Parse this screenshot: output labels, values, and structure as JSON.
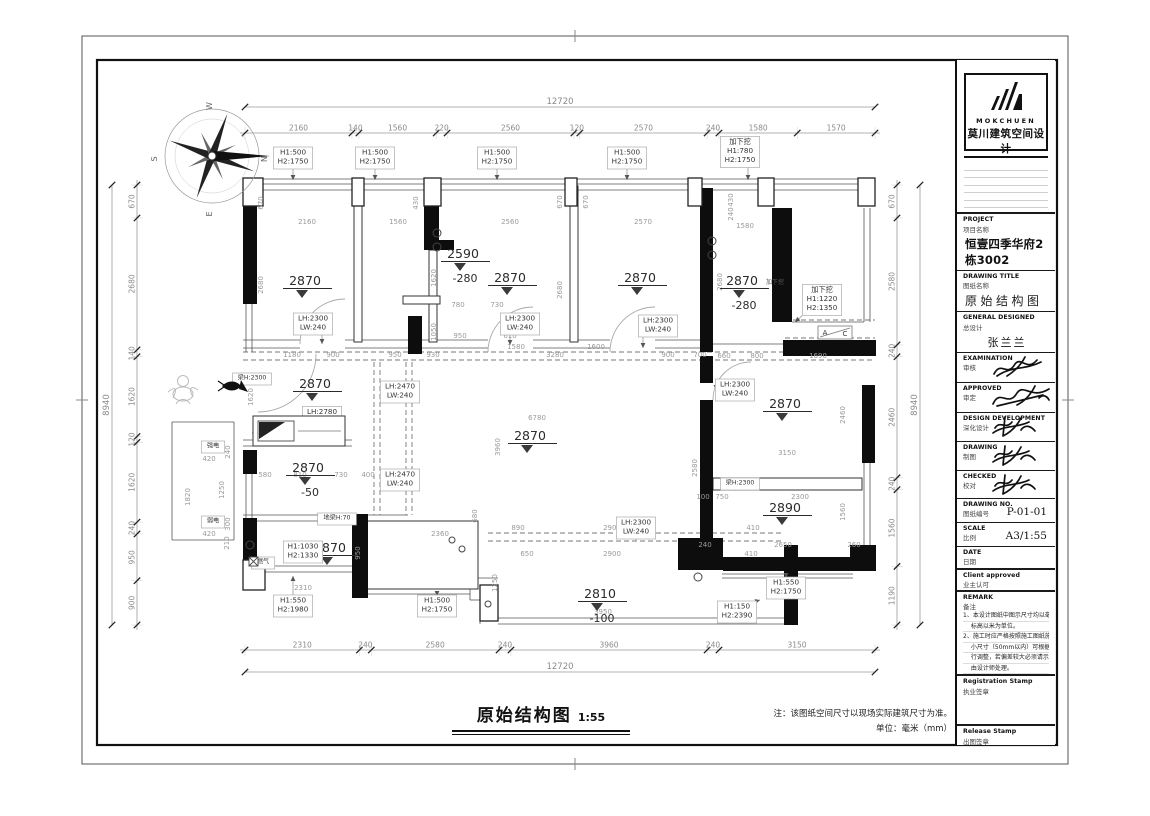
{
  "footer": {
    "title": "原始结构图",
    "scale": "1:55",
    "note1": "注：该图纸空间尺寸以现场实际建筑尺寸为准。",
    "note2": "单位：毫米（mm）"
  },
  "titleblock": {
    "logo": {
      "brand": "MOKCHUEN",
      "brand_cn": "莫川建筑空间设计"
    },
    "rows": [
      {
        "en": "PROJECT",
        "cn": "项目名称",
        "value": "恒壹四季华府2栋3002",
        "style": "lg",
        "h": 40,
        "thick": true
      },
      {
        "en": "DRAWING TITLE",
        "cn": "图纸名称",
        "value": "原始结构图",
        "style": "spaced",
        "h": 38
      },
      {
        "en": "GENERAL DESIGNED",
        "cn": "总设计",
        "value": "张兰兰",
        "style": "center",
        "h": 34
      },
      {
        "en": "EXAMINATION",
        "cn": "审核",
        "sig": 1,
        "h": 30
      },
      {
        "en": "APPROVED",
        "cn": "审定",
        "sig": 2,
        "h": 30
      },
      {
        "en": "DESIGN DEVELOPMENT",
        "cn": "深化设计",
        "sig": 3,
        "h": 29
      },
      {
        "en": "DRAWING",
        "cn": "制图",
        "sig": 3,
        "h": 29
      },
      {
        "en": "CHECKED",
        "cn": "校对",
        "sig": 3,
        "h": 28
      },
      {
        "en": "DRAWING NO.",
        "cn": "图纸编号",
        "value": "P-01-01",
        "style": "inline",
        "h": 24
      },
      {
        "en": "SCALE",
        "cn": "比例",
        "value": "A3/1:55",
        "style": "inline",
        "h": 24
      },
      {
        "en": "DATE",
        "cn": "日期",
        "h": 22
      },
      {
        "en": "Client approved",
        "cn": "业主认可",
        "h": 22,
        "thick": true
      }
    ],
    "remark": {
      "en": "REMARK",
      "cn": "备注",
      "thick": true,
      "lines": [
        "1、本设计图纸中图示尺寸均以毫米为单位，",
        "　 标高以米为单位。",
        "2、施工时应严格按照施工图纸施工，局部",
        "　 小尺寸（50mm以内）可根据现场实况进",
        "　 行调整，若偏差较大必须请示设计师，",
        "　 由设计师处理。"
      ]
    },
    "stamps": [
      {
        "en": "Registration Stamp",
        "cn": "执业签章",
        "h": 50,
        "thick": true
      },
      {
        "en": "Release Stamp",
        "cn": "出图签章",
        "h": 58,
        "thick": true
      }
    ]
  },
  "plan": {
    "chains": [
      {
        "o": "h",
        "x0": 245,
        "x1": 875,
        "y": 133,
        "vals": [
          2160,
          140,
          1560,
          220,
          2560,
          120,
          2570,
          240,
          1580,
          1570
        ]
      },
      {
        "o": "h",
        "x0": 245,
        "x1": 875,
        "y": 650,
        "vals": [
          2310,
          240,
          2580,
          240,
          3960,
          240,
          3150
        ]
      },
      {
        "o": "v",
        "x": 137,
        "y0": 185,
        "y1": 625,
        "vals": [
          670,
          2680,
          140,
          1620,
          120,
          1620,
          240,
          950,
          900
        ]
      },
      {
        "o": "v",
        "x": 897,
        "y0": 185,
        "y1": 625,
        "vals": [
          670,
          2580,
          240,
          2460,
          240,
          1560,
          1190
        ]
      }
    ],
    "overall": [
      {
        "o": "h",
        "x0": 245,
        "x1": 875,
        "y": 107,
        "t": "12720"
      },
      {
        "o": "h",
        "x0": 245,
        "x1": 875,
        "y": 672,
        "t": "12720"
      },
      {
        "o": "v",
        "x": 112,
        "y0": 185,
        "y1": 625,
        "t": "8940"
      },
      {
        "o": "v",
        "x": 920,
        "y0": 185,
        "y1": 625,
        "t": "8940"
      }
    ],
    "walls": [
      [
        243,
        204,
        14,
        100
      ],
      [
        243,
        450,
        14,
        24
      ],
      [
        243,
        518,
        14,
        46
      ],
      [
        352,
        514,
        16,
        84
      ],
      [
        408,
        316,
        14,
        38
      ],
      [
        424,
        204,
        15,
        38
      ],
      [
        424,
        240,
        30,
        10
      ],
      [
        700,
        188,
        13,
        164
      ],
      [
        772,
        208,
        20,
        114
      ],
      [
        783,
        340,
        93,
        16
      ],
      [
        700,
        356,
        13,
        27
      ],
      [
        700,
        400,
        13,
        140
      ],
      [
        678,
        538,
        45,
        32
      ],
      [
        784,
        545,
        14,
        80
      ],
      [
        723,
        557,
        127,
        14
      ],
      [
        850,
        545,
        26,
        26
      ],
      [
        862,
        385,
        13,
        78
      ]
    ],
    "columns": [
      [
        243,
        178,
        20,
        28
      ],
      [
        352,
        178,
        12,
        28
      ],
      [
        424,
        178,
        17,
        28
      ],
      [
        565,
        178,
        12,
        28
      ],
      [
        688,
        178,
        14,
        28
      ],
      [
        758,
        178,
        16,
        28
      ],
      [
        858,
        178,
        17,
        28
      ],
      [
        243,
        560,
        22,
        30
      ],
      [
        480,
        585,
        18,
        36
      ]
    ],
    "thinwalls": [
      [
        354,
        186,
        8,
        156
      ],
      [
        429,
        250,
        8,
        92
      ],
      [
        570,
        186,
        8,
        156
      ],
      [
        713,
        478,
        149,
        12
      ],
      [
        403,
        296,
        37,
        8
      ],
      [
        366,
        521,
        112,
        68
      ]
    ],
    "lines": [
      [
        243,
        179,
        875,
        179
      ],
      [
        243,
        184,
        875,
        184
      ],
      [
        243,
        190,
        875,
        190
      ],
      [
        246,
        304,
        246,
        352
      ],
      [
        252,
        304,
        252,
        352
      ],
      [
        246,
        466,
        246,
        518
      ],
      [
        252,
        466,
        252,
        518
      ],
      [
        257,
        566,
        352,
        566
      ],
      [
        257,
        572,
        352,
        572
      ],
      [
        498,
        618,
        790,
        618
      ],
      [
        498,
        624,
        790,
        624
      ],
      [
        470,
        578,
        498,
        578
      ],
      [
        470,
        578,
        470,
        600
      ],
      [
        470,
        600,
        480,
        600
      ],
      [
        480,
        600,
        480,
        624
      ],
      [
        864,
        208,
        864,
        322
      ],
      [
        870,
        208,
        870,
        322
      ],
      [
        864,
        460,
        864,
        545
      ],
      [
        870,
        460,
        870,
        545
      ],
      [
        243,
        340,
        300,
        340
      ],
      [
        243,
        348,
        300,
        348
      ],
      [
        345,
        340,
        488,
        340
      ],
      [
        345,
        348,
        488,
        348
      ],
      [
        533,
        340,
        610,
        340
      ],
      [
        533,
        348,
        610,
        348
      ],
      [
        655,
        340,
        700,
        340
      ],
      [
        655,
        348,
        700,
        348
      ],
      [
        713,
        344,
        783,
        344
      ],
      [
        243,
        440,
        352,
        440
      ],
      [
        243,
        446,
        352,
        446
      ],
      [
        243,
        515,
        408,
        515
      ],
      [
        243,
        521,
        408,
        521
      ],
      [
        365,
        588,
        470,
        588
      ],
      [
        365,
        594,
        470,
        594
      ],
      [
        722,
        574,
        853,
        574
      ],
      [
        722,
        578,
        853,
        578
      ],
      [
        792,
        322,
        864,
        322
      ],
      [
        172,
        422,
        234,
        422
      ],
      [
        172,
        422,
        172,
        540
      ],
      [
        172,
        540,
        234,
        540
      ],
      [
        234,
        422,
        234,
        540
      ]
    ],
    "dashed": [
      [
        243,
        352,
        875,
        352
      ],
      [
        243,
        360,
        875,
        360
      ],
      [
        374,
        362,
        374,
        515
      ],
      [
        380,
        362,
        380,
        515
      ],
      [
        406,
        362,
        406,
        515
      ],
      [
        412,
        362,
        412,
        515
      ],
      [
        488,
        533,
        784,
        533
      ],
      [
        488,
        541,
        784,
        541
      ],
      [
        785,
        320,
        875,
        320
      ],
      [
        785,
        338,
        875,
        338
      ],
      [
        252,
        433,
        348,
        433
      ]
    ],
    "circles": [
      [
        437,
        233,
        4
      ],
      [
        437,
        247,
        4
      ],
      [
        712,
        241,
        4
      ],
      [
        712,
        255,
        4
      ],
      [
        250,
        545,
        4
      ],
      [
        452,
        540,
        3
      ],
      [
        462,
        549,
        3
      ],
      [
        698,
        577,
        4
      ],
      [
        488,
        604,
        3
      ]
    ],
    "arcs": [
      "M316,354 A58,58 0 0 1 258,412",
      "M300,344 A45,45 0 0 1 345,299",
      "M488,352 A45,45 0 0 1 533,307",
      "M610,352 A45,45 0 0 1 655,307",
      "M713,400 A38,38 0 0 1 751,362"
    ],
    "levels": [
      {
        "v": "2870",
        "x": 305,
        "y": 285
      },
      {
        "v": "2590",
        "x": 463,
        "y": 258,
        "sub": "-280"
      },
      {
        "v": "2870",
        "x": 510,
        "y": 282
      },
      {
        "v": "2870",
        "x": 640,
        "y": 282
      },
      {
        "v": "2870",
        "x": 742,
        "y": 285,
        "sub": "-280",
        "tag": "加下挖"
      },
      {
        "v": "2870",
        "x": 315,
        "y": 388
      },
      {
        "v": "2870",
        "x": 530,
        "y": 440
      },
      {
        "v": "2870",
        "x": 308,
        "y": 472,
        "sub": "-50"
      },
      {
        "v": "2870",
        "x": 330,
        "y": 552
      },
      {
        "v": "2870",
        "x": 785,
        "y": 408
      },
      {
        "v": "2890",
        "x": 785,
        "y": 512
      },
      {
        "v": "2810",
        "x": 600,
        "y": 598,
        "sub": "-100"
      }
    ],
    "labels": [
      {
        "t": [
          "H1:500",
          "H2:1750"
        ],
        "x": 293,
        "y": 158,
        "lead": [
          293,
          180
        ]
      },
      {
        "t": [
          "H1:500",
          "H2:1750"
        ],
        "x": 375,
        "y": 158,
        "lead": [
          375,
          180
        ]
      },
      {
        "t": [
          "H1:500",
          "H2:1750"
        ],
        "x": 497,
        "y": 158,
        "lead": [
          497,
          180
        ]
      },
      {
        "t": [
          "H1:500",
          "H2:1750"
        ],
        "x": 627,
        "y": 158,
        "lead": [
          627,
          180
        ]
      },
      {
        "t": [
          "加下挖",
          "H1:780",
          "H2:1750"
        ],
        "x": 740,
        "y": 152,
        "lead": [
          748,
          180
        ]
      },
      {
        "t": [
          "加下挖",
          "H1:1220",
          "H2:1350"
        ],
        "x": 822,
        "y": 300,
        "lead": [
          795,
          322
        ]
      },
      {
        "t": [
          "LH:2300",
          "LW:240"
        ],
        "x": 313,
        "y": 324,
        "lead": [
          322,
          344
        ]
      },
      {
        "t": [
          "LH:2300",
          "LW:240"
        ],
        "x": 520,
        "y": 324,
        "lead": [
          510,
          345
        ]
      },
      {
        "t": [
          "LH:2300",
          "LW:240"
        ],
        "x": 658,
        "y": 326,
        "lead": [
          643,
          348
        ]
      },
      {
        "t": [
          "LH:2470",
          "LW:240"
        ],
        "x": 400,
        "y": 392,
        "lead": [
          414,
          392
        ]
      },
      {
        "t": [
          "LH:2470",
          "LW:240"
        ],
        "x": 400,
        "y": 480,
        "lead": [
          414,
          480
        ]
      },
      {
        "t": [
          "LH:2780"
        ],
        "x": 322,
        "y": 413
      },
      {
        "t": [
          "梁H:2300"
        ],
        "x": 252,
        "y": 379,
        "small": true
      },
      {
        "t": [
          "LH:2300",
          "LW:240"
        ],
        "x": 735,
        "y": 390,
        "lead": [
          716,
          390
        ]
      },
      {
        "t": [
          "梁H:2300"
        ],
        "x": 740,
        "y": 484,
        "small": true
      },
      {
        "t": [
          "地梁H:70"
        ],
        "x": 337,
        "y": 519,
        "small": true
      },
      {
        "t": [
          "H1:1030",
          "H2:1330"
        ],
        "x": 303,
        "y": 552
      },
      {
        "t": [
          "H1:550",
          "H2:1980"
        ],
        "x": 293,
        "y": 606,
        "lead": [
          293,
          576
        ]
      },
      {
        "t": [
          "H1:500",
          "H2:1750"
        ],
        "x": 437,
        "y": 606,
        "lead": [
          437,
          596
        ]
      },
      {
        "t": [
          "H1:550",
          "H2:1750"
        ],
        "x": 786,
        "y": 588,
        "lead": [
          786,
          578
        ]
      },
      {
        "t": [
          "H1:150",
          "H2:2390"
        ],
        "x": 737,
        "y": 612,
        "lead": [
          760,
          600
        ]
      },
      {
        "t": [
          "LH:2300",
          "LW:240"
        ],
        "x": 636,
        "y": 528,
        "lead": [
          636,
          540
        ]
      },
      {
        "t": [
          "强电"
        ],
        "x": 213,
        "y": 447,
        "small": true
      },
      {
        "t": [
          "弱电"
        ],
        "x": 213,
        "y": 522,
        "small": true
      },
      {
        "t": [
          "燃气"
        ],
        "x": 263,
        "y": 563,
        "small": true
      }
    ],
    "section_marker": {
      "a": "A",
      "c": "C",
      "x": 818,
      "y": 326,
      "w": 34,
      "h": 13
    },
    "dims": [
      [
        "2160",
        307,
        224
      ],
      [
        "1560",
        398,
        224
      ],
      [
        "2560",
        510,
        224
      ],
      [
        "2570",
        643,
        224
      ],
      [
        "1580",
        745,
        228
      ],
      [
        "670",
        263,
        203,
        1
      ],
      [
        "2680",
        263,
        285,
        1
      ],
      [
        "430",
        418,
        203,
        1
      ],
      [
        "1620",
        436,
        278,
        1
      ],
      [
        "1050",
        436,
        332,
        1
      ],
      [
        "780",
        458,
        307
      ],
      [
        "730",
        497,
        307
      ],
      [
        "950",
        460,
        338
      ],
      [
        "610",
        510,
        338
      ],
      [
        "810",
        518,
        320,
        1
      ],
      [
        "430",
        733,
        200,
        1
      ],
      [
        "240",
        733,
        214,
        1
      ],
      [
        "2680",
        722,
        282,
        1
      ],
      [
        "660",
        724,
        358
      ],
      [
        "800",
        757,
        358
      ],
      [
        "1690",
        818,
        358
      ],
      [
        "1180",
        292,
        357
      ],
      [
        "900",
        333,
        357
      ],
      [
        "950",
        395,
        357
      ],
      [
        "930",
        433,
        357
      ],
      [
        "3280",
        555,
        357
      ],
      [
        "900",
        668,
        357
      ],
      [
        "700",
        700,
        357
      ],
      [
        "1580",
        516,
        349
      ],
      [
        "1600",
        596,
        349
      ],
      [
        "670",
        562,
        202,
        1
      ],
      [
        "670",
        588,
        202,
        1
      ],
      [
        "2680",
        562,
        290,
        1
      ],
      [
        "2550",
        312,
        424
      ],
      [
        "1620",
        253,
        397,
        1
      ],
      [
        "580",
        265,
        477
      ],
      [
        "810",
        300,
        477
      ],
      [
        "730",
        341,
        477
      ],
      [
        "400",
        368,
        477
      ],
      [
        "2310",
        303,
        590
      ],
      [
        "950",
        360,
        553,
        1
      ],
      [
        "6780",
        537,
        420
      ],
      [
        "3960",
        500,
        447,
        1
      ],
      [
        "2360",
        440,
        536
      ],
      [
        "680",
        477,
        516,
        1
      ],
      [
        "2580",
        697,
        468,
        1
      ],
      [
        "890",
        518,
        530
      ],
      [
        "2900",
        612,
        530
      ],
      [
        "410",
        753,
        530
      ],
      [
        "650",
        527,
        556
      ],
      [
        "2900",
        612,
        556
      ],
      [
        "410",
        751,
        556
      ],
      [
        "1250",
        497,
        583,
        1
      ],
      [
        "3950",
        603,
        614
      ],
      [
        "950",
        795,
        588,
        1
      ],
      [
        "2460",
        845,
        415,
        1
      ],
      [
        "3150",
        787,
        455
      ],
      [
        "100",
        703,
        499
      ],
      [
        "750",
        722,
        499
      ],
      [
        "2300",
        800,
        499
      ],
      [
        "1560",
        845,
        512,
        1
      ],
      [
        "2650",
        783,
        547
      ],
      [
        "240",
        705,
        547
      ],
      [
        "260",
        854,
        547
      ],
      [
        "420",
        209,
        461
      ],
      [
        "420",
        209,
        536
      ],
      [
        "1820",
        190,
        497,
        1
      ],
      [
        "1250",
        224,
        490,
        1
      ],
      [
        "240",
        230,
        452,
        1
      ],
      [
        "300",
        230,
        524,
        1
      ],
      [
        "210",
        229,
        543,
        1
      ]
    ],
    "compass": {
      "x": 212,
      "y": 156,
      "letters": [
        "N",
        "E",
        "S",
        "W"
      ]
    }
  }
}
